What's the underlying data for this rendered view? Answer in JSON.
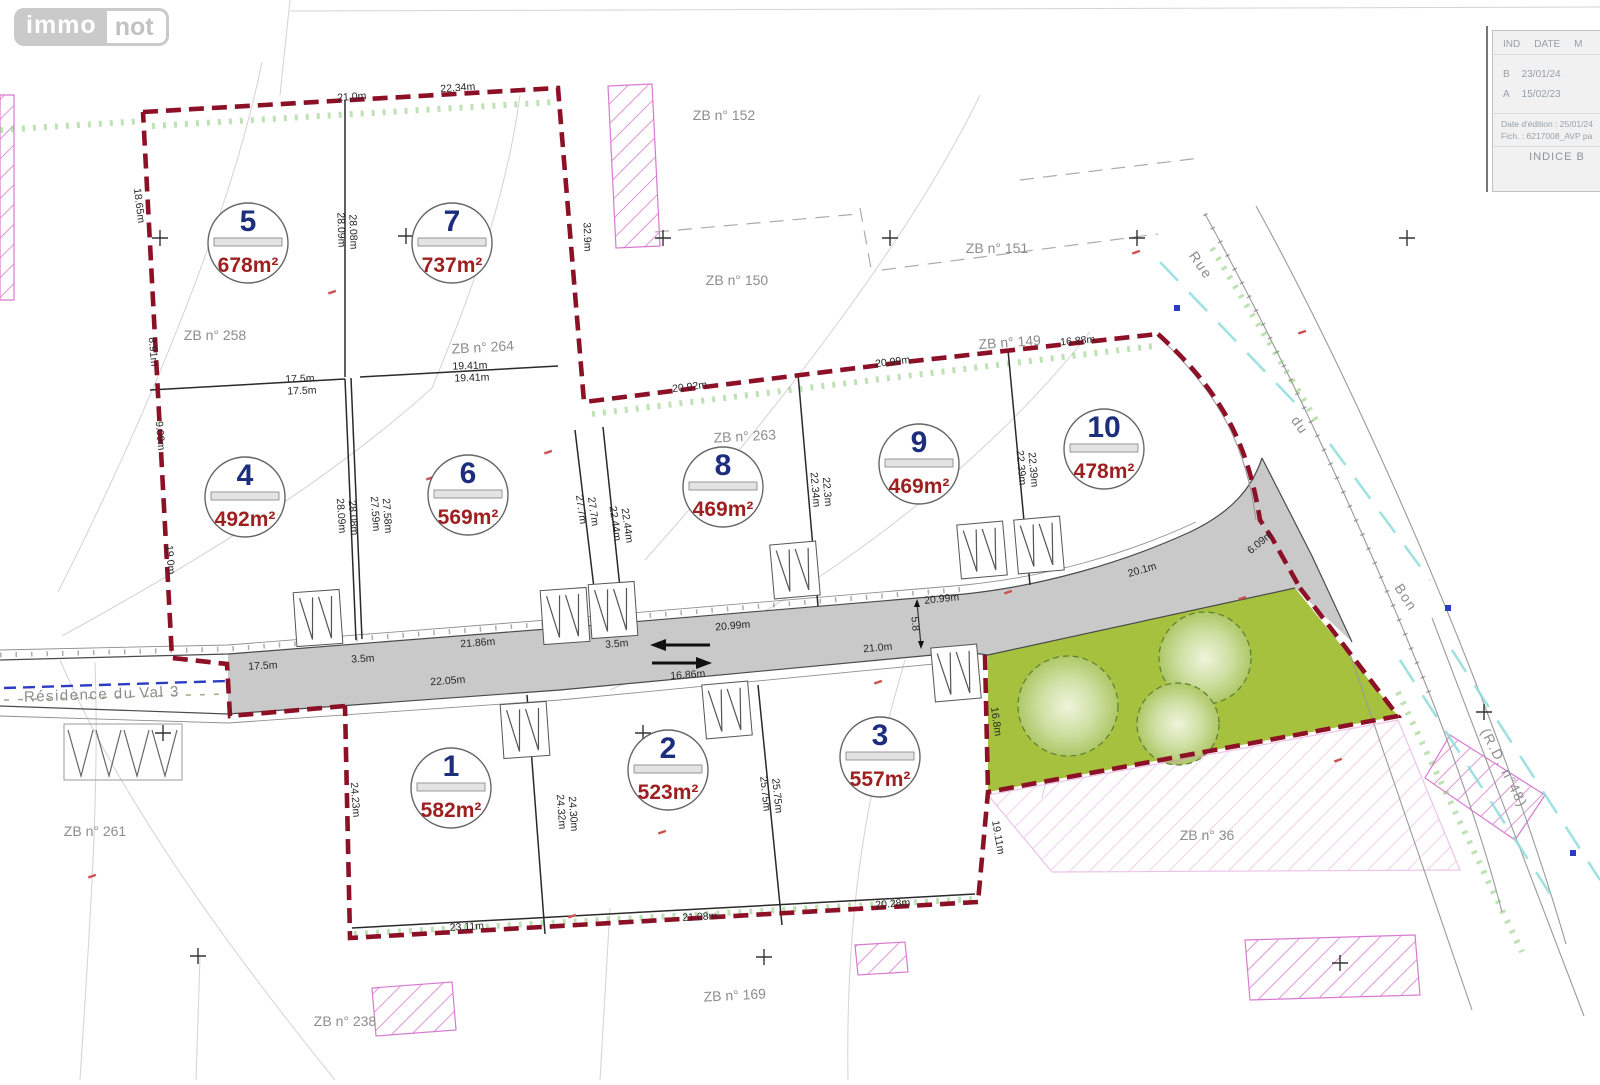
{
  "logo": {
    "immo": "immo",
    "not": "not"
  },
  "title_block": {
    "header": {
      "ind": "IND",
      "date": "DATE",
      "m": "M"
    },
    "rows": [
      {
        "ind": "B",
        "date": "23/01/24"
      },
      {
        "ind": "A",
        "date": "15/02/23"
      }
    ],
    "edition": "Date d'édition : 25/01/24",
    "fich": "Fich. : 6217008_AVP pa",
    "indice": "INDICE B"
  },
  "map": {
    "colors": {
      "maroon": "#8c1127",
      "navy": "#1d2e7d",
      "red": "#9e1f1f",
      "green": "#a6c13e",
      "road": "#c9c9c9",
      "cyan": "#8fdcdc",
      "pink": "#d87ad0",
      "greenhatch": "#7dc36b",
      "blue": "#2b3cc4",
      "graylabel": "#8d8d8d",
      "line": "#2a2a2a"
    },
    "lots": [
      {
        "num": "5",
        "area": "678m²",
        "x": 248,
        "y": 243
      },
      {
        "num": "7",
        "area": "737m²",
        "x": 452,
        "y": 243
      },
      {
        "num": "4",
        "area": "492m²",
        "x": 245,
        "y": 497
      },
      {
        "num": "6",
        "area": "569m²",
        "x": 468,
        "y": 495
      },
      {
        "num": "8",
        "area": "469m²",
        "x": 723,
        "y": 487
      },
      {
        "num": "9",
        "area": "469m²",
        "x": 919,
        "y": 464
      },
      {
        "num": "10",
        "area": "478m²",
        "x": 1104,
        "y": 449
      },
      {
        "num": "1",
        "area": "582m²",
        "x": 451,
        "y": 788
      },
      {
        "num": "2",
        "area": "523m²",
        "x": 668,
        "y": 770
      },
      {
        "num": "3",
        "area": "557m²",
        "x": 880,
        "y": 757
      }
    ],
    "parcel_labels": [
      {
        "t": "ZB n° 152",
        "x": 724,
        "y": 120,
        "r": 0
      },
      {
        "t": "ZB n° 151",
        "x": 997,
        "y": 253,
        "r": 0
      },
      {
        "t": "ZB n° 150",
        "x": 737,
        "y": 285,
        "r": 0
      },
      {
        "t": "ZB n° 149",
        "x": 1010,
        "y": 347,
        "r": -4
      },
      {
        "t": "ZB n° 258",
        "x": 215,
        "y": 340,
        "r": 0
      },
      {
        "t": "ZB n° 264",
        "x": 483,
        "y": 352,
        "r": -3
      },
      {
        "t": "ZB n° 263",
        "x": 745,
        "y": 441,
        "r": -3
      },
      {
        "t": "ZB n° 261",
        "x": 95,
        "y": 836,
        "r": 0
      },
      {
        "t": "ZB n° 36",
        "x": 1207,
        "y": 840,
        "r": 0
      },
      {
        "t": "ZB n° 169",
        "x": 735,
        "y": 1000,
        "r": -3
      },
      {
        "t": "ZB n° 238",
        "x": 345,
        "y": 1026,
        "r": 0
      }
    ],
    "dim_labels": [
      {
        "t": "21.0m",
        "x": 352,
        "y": 100,
        "r": -4
      },
      {
        "t": "22.34m",
        "x": 458,
        "y": 91,
        "r": -4
      },
      {
        "t": "18.65m",
        "x": 136,
        "y": 206,
        "r": 83
      },
      {
        "t": "8.91m",
        "x": 150,
        "y": 352,
        "r": 85
      },
      {
        "t": "9.09m",
        "x": 157,
        "y": 436,
        "r": 85
      },
      {
        "t": "19.0m",
        "x": 167,
        "y": 560,
        "r": 85
      },
      {
        "t": "28.09m",
        "x": 338,
        "y": 230,
        "r": 88
      },
      {
        "t": "28.08m",
        "x": 350,
        "y": 232,
        "r": 88
      },
      {
        "t": "32.9m",
        "x": 584,
        "y": 237,
        "r": 88
      },
      {
        "t": "17.5m",
        "x": 300,
        "y": 382,
        "r": -2
      },
      {
        "t": "17.5m",
        "x": 302,
        "y": 394,
        "r": -2
      },
      {
        "t": "19.41m",
        "x": 470,
        "y": 369,
        "r": -2
      },
      {
        "t": "19.41m",
        "x": 472,
        "y": 381,
        "r": -2
      },
      {
        "t": "28.09m",
        "x": 338,
        "y": 516,
        "r": 86
      },
      {
        "t": "28.08m",
        "x": 350,
        "y": 518,
        "r": 86
      },
      {
        "t": "27.59m",
        "x": 372,
        "y": 514,
        "r": 86
      },
      {
        "t": "27.58m",
        "x": 384,
        "y": 516,
        "r": 86
      },
      {
        "t": "27.7m",
        "x": 578,
        "y": 510,
        "r": 82
      },
      {
        "t": "27.7m",
        "x": 590,
        "y": 512,
        "r": 82
      },
      {
        "t": "22.44m",
        "x": 612,
        "y": 524,
        "r": 82
      },
      {
        "t": "22.44m",
        "x": 624,
        "y": 526,
        "r": 82
      },
      {
        "t": "20.92m",
        "x": 690,
        "y": 390,
        "r": -7
      },
      {
        "t": "20.99m",
        "x": 893,
        "y": 365,
        "r": -7
      },
      {
        "t": "16.88m",
        "x": 1078,
        "y": 344,
        "r": -5
      },
      {
        "t": "22.34m",
        "x": 812,
        "y": 490,
        "r": 85
      },
      {
        "t": "22.3m",
        "x": 824,
        "y": 492,
        "r": 85
      },
      {
        "t": "22.39m",
        "x": 1018,
        "y": 468,
        "r": 85
      },
      {
        "t": "22.39m",
        "x": 1030,
        "y": 470,
        "r": 85
      },
      {
        "t": "20.99m",
        "x": 733,
        "y": 629,
        "r": -5
      },
      {
        "t": "20.99m",
        "x": 942,
        "y": 602,
        "r": -6
      },
      {
        "t": "20.1m",
        "x": 1143,
        "y": 573,
        "r": -16
      },
      {
        "t": "5.8",
        "x": 912,
        "y": 624,
        "r": 85
      },
      {
        "t": "3.5m",
        "x": 617,
        "y": 647,
        "r": -4
      },
      {
        "t": "17.5m",
        "x": 263,
        "y": 669,
        "r": -3
      },
      {
        "t": "3.5m",
        "x": 363,
        "y": 662,
        "r": -3
      },
      {
        "t": "21.86m",
        "x": 478,
        "y": 646,
        "r": -4
      },
      {
        "t": "16.86m",
        "x": 688,
        "y": 678,
        "r": -4
      },
      {
        "t": "22.05m",
        "x": 448,
        "y": 684,
        "r": -4
      },
      {
        "t": "21.0m",
        "x": 878,
        "y": 651,
        "r": -5
      },
      {
        "t": "23.11m",
        "x": 467,
        "y": 930,
        "r": -3
      },
      {
        "t": "21.08m",
        "x": 700,
        "y": 920,
        "r": -3
      },
      {
        "t": "20.28m",
        "x": 893,
        "y": 907,
        "r": -4
      },
      {
        "t": "24.23m",
        "x": 352,
        "y": 800,
        "r": 86
      },
      {
        "t": "24.32m",
        "x": 558,
        "y": 812,
        "r": 86
      },
      {
        "t": "24.30m",
        "x": 570,
        "y": 814,
        "r": 86
      },
      {
        "t": "25.75m",
        "x": 762,
        "y": 794,
        "r": 84
      },
      {
        "t": "25.75m",
        "x": 774,
        "y": 796,
        "r": 84
      },
      {
        "t": "19.11m",
        "x": 995,
        "y": 838,
        "r": 80
      },
      {
        "t": "16.8m",
        "x": 993,
        "y": 722,
        "r": 82
      },
      {
        "t": "6.09m",
        "x": 1262,
        "y": 545,
        "r": -40
      }
    ],
    "street_labels": [
      {
        "t": "Rue",
        "x": 1197,
        "y": 268,
        "r": 55,
        "s": 14
      },
      {
        "t": "du",
        "x": 1296,
        "y": 428,
        "r": 55,
        "s": 14
      },
      {
        "t": "Bon",
        "x": 1402,
        "y": 600,
        "r": 57,
        "s": 14
      },
      {
        "t": "(R.D. n°48)",
        "x": 1500,
        "y": 770,
        "r": 63,
        "s": 14
      },
      {
        "t": "Résidence du Val 3",
        "x": 102,
        "y": 699,
        "r": -2,
        "s": 15
      }
    ],
    "driveways": [
      {
        "x": 318,
        "y": 618,
        "r": -4
      },
      {
        "x": 565,
        "y": 616,
        "r": -4
      },
      {
        "x": 613,
        "y": 610,
        "r": -4
      },
      {
        "x": 795,
        "y": 570,
        "r": -5
      },
      {
        "x": 982,
        "y": 550,
        "r": -5
      },
      {
        "x": 1039,
        "y": 545,
        "r": -5
      },
      {
        "x": 525,
        "y": 730,
        "r": -4
      },
      {
        "x": 727,
        "y": 710,
        "r": -5
      },
      {
        "x": 956,
        "y": 673,
        "r": -5
      }
    ],
    "crosses": [
      [
        160,
        238
      ],
      [
        406,
        236
      ],
      [
        663,
        238
      ],
      [
        890,
        238
      ],
      [
        1137,
        238
      ],
      [
        1407,
        238
      ],
      [
        163,
        733
      ],
      [
        643,
        733
      ],
      [
        198,
        956
      ],
      [
        764,
        957
      ],
      [
        1340,
        963
      ],
      [
        1484,
        712
      ]
    ],
    "blue_marks": [
      [
        1177,
        308
      ],
      [
        1448,
        608
      ],
      [
        1573,
        853
      ]
    ],
    "red_marks": [
      [
        332,
        292
      ],
      [
        430,
        478
      ],
      [
        548,
        452
      ],
      [
        878,
        682
      ],
      [
        1242,
        598
      ],
      [
        1136,
        252
      ],
      [
        1302,
        332
      ],
      [
        92,
        876
      ],
      [
        572,
        916
      ],
      [
        662,
        832
      ],
      [
        1008,
        592
      ],
      [
        1338,
        760
      ]
    ]
  }
}
